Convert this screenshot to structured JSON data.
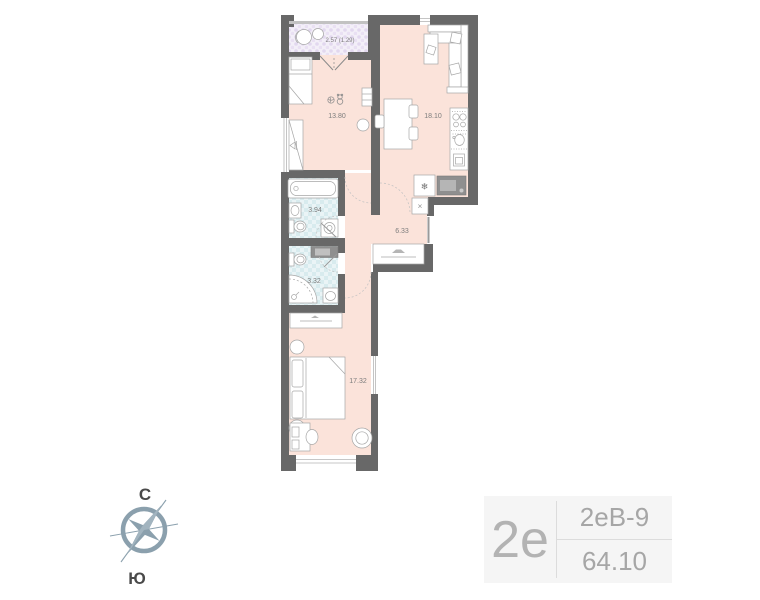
{
  "plan": {
    "rooms": [
      {
        "name": "balcony",
        "area": "2.57 (1.29)"
      },
      {
        "name": "living-room",
        "area": "13.80"
      },
      {
        "name": "kitchen-living-room",
        "area": "18.10"
      },
      {
        "name": "bathroom",
        "area": "3.94"
      },
      {
        "name": "hallway",
        "area": "6.33"
      },
      {
        "name": "shower-room",
        "area": "3.32"
      },
      {
        "name": "bedroom",
        "area": "17.32"
      }
    ],
    "icons": {
      "fridge": "❄",
      "shaft": "✕"
    }
  },
  "compass": {
    "north_label": "С",
    "south_label": "Ю"
  },
  "info_panel": {
    "plan_type": "2е",
    "plan_code": "2еВ-9",
    "total_area": "64.10"
  },
  "colors": {
    "floor_pink": "#fbe3da",
    "wet_floor": "#dcedf0",
    "balcony_floor": "#ece4f4",
    "wall": "#686868",
    "label_text": "#7d7d7d",
    "panel_bg": "#f5f5f5",
    "panel_text": "#a8a8a8",
    "compass": "#8ba0ad"
  }
}
